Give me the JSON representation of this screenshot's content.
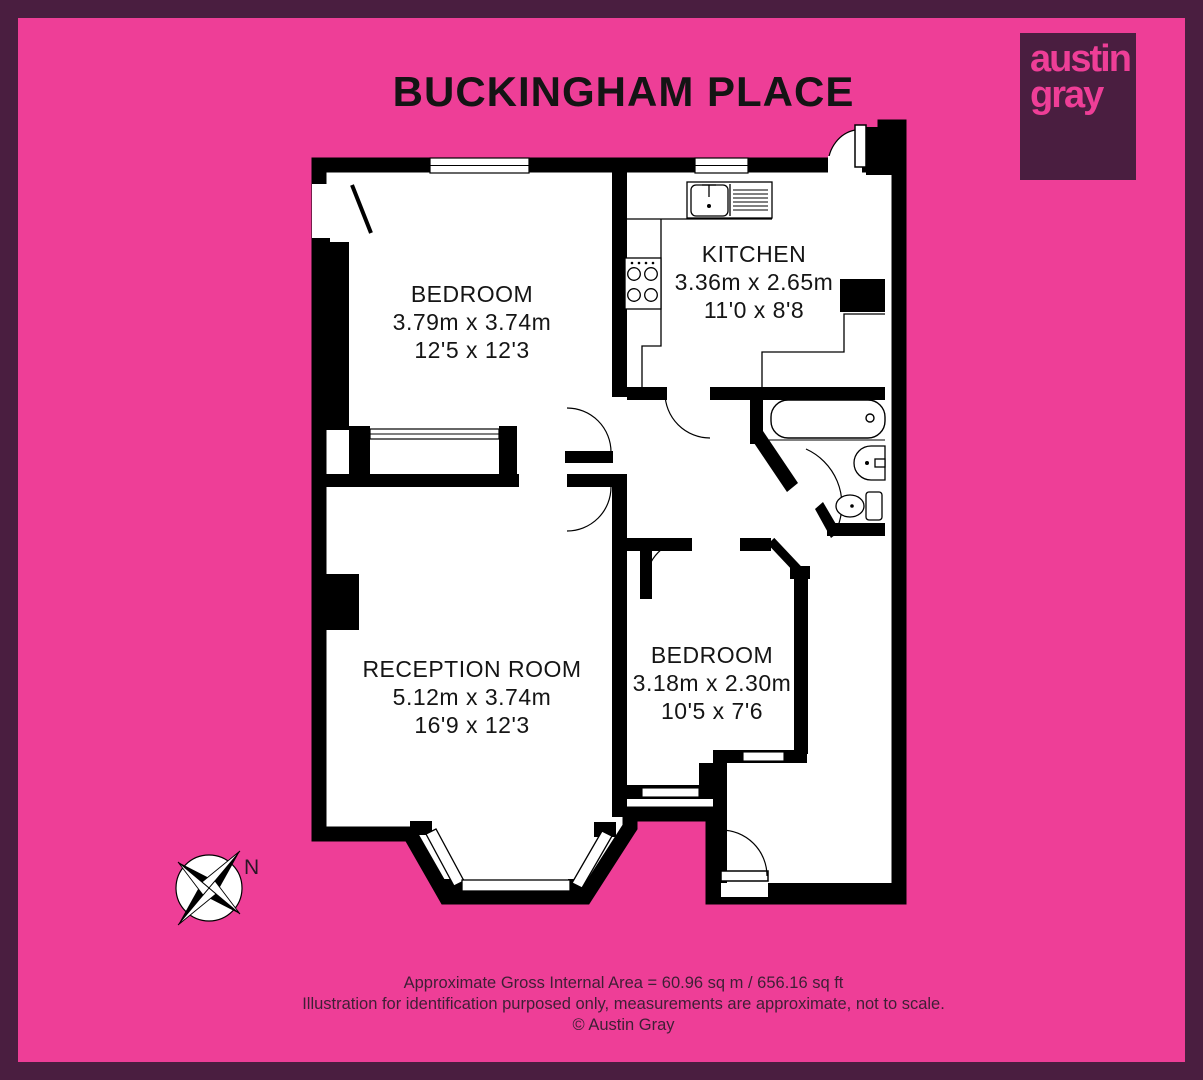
{
  "title": "BUCKINGHAM PLACE",
  "logo": {
    "word1": "austin",
    "word2": "gray"
  },
  "colors": {
    "background": "#ee3e97",
    "border": "#4a1e40",
    "wall": "#000000",
    "floor": "#ffffff",
    "footer_text": "#3e1f35"
  },
  "rooms": [
    {
      "id": "bedroom-1",
      "name": "BEDROOM",
      "metric": "3.79m x 3.74m",
      "imperial": "12'5 x 12'3"
    },
    {
      "id": "kitchen",
      "name": "KITCHEN",
      "metric": "3.36m x 2.65m",
      "imperial": "11'0 x 8'8"
    },
    {
      "id": "reception-room",
      "name": "RECEPTION ROOM",
      "metric": "5.12m x 3.74m",
      "imperial": "16'9 x 12'3"
    },
    {
      "id": "bedroom-2",
      "name": "BEDROOM",
      "metric": "3.18m x 2.30m",
      "imperial": "10'5 x 7'6"
    }
  ],
  "fixtures": [
    "bathtub",
    "basin",
    "toilet",
    "kitchen-sink",
    "hob"
  ],
  "compass": {
    "north_label": "N"
  },
  "footer": {
    "area_line": "Approximate Gross Internal Area = 60.96 sq m / 656.16 sq ft",
    "disclaimer_line": "Illustration for identification purposed only, measurements are approximate, not to scale.",
    "copyright_line": "© Austin Gray"
  }
}
